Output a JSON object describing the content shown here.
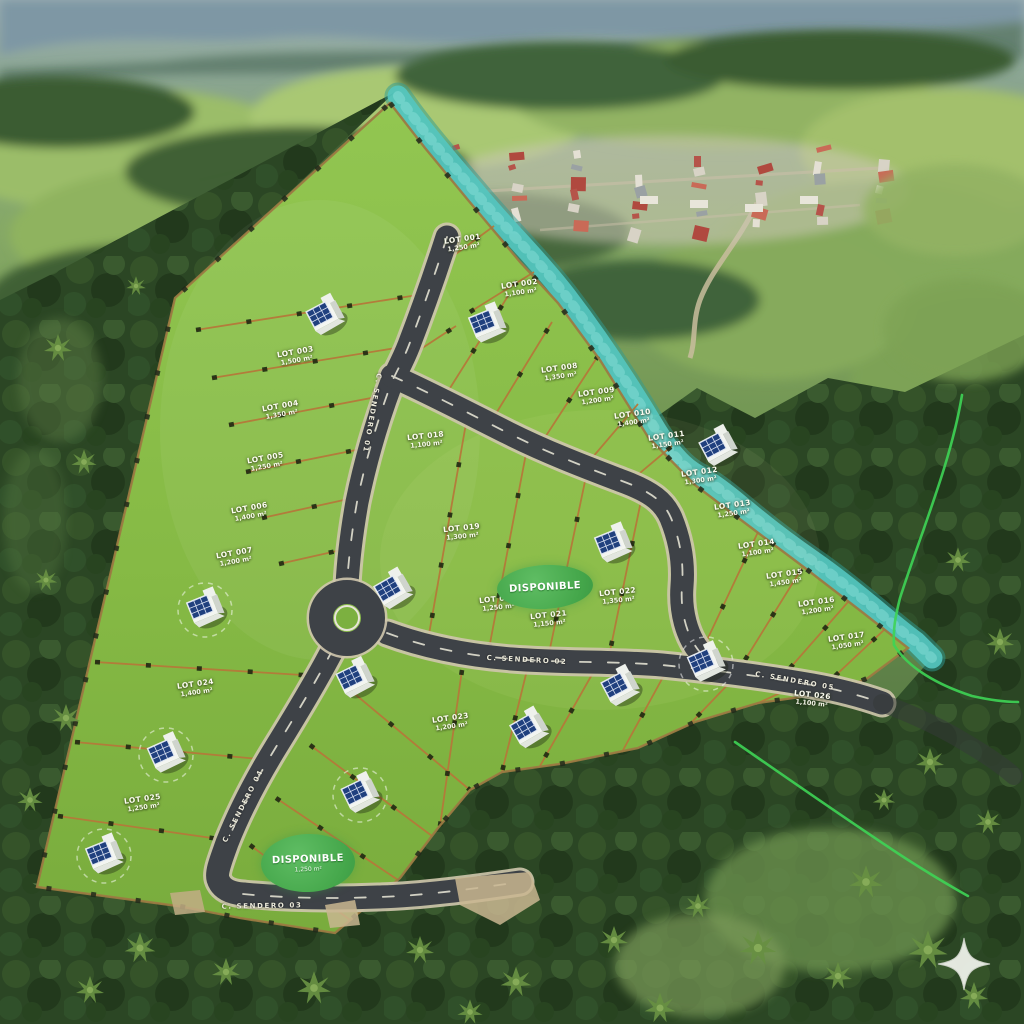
{
  "map": {
    "colors": {
      "parcel_green": "#86ba45",
      "lot_line": "#b5793a",
      "river_teal": "#54c7c0",
      "road_asphalt": "#3e4247",
      "badge_green": "#45a74b",
      "survey_line_green": "#3ed455",
      "label_text": "#fdfdf2",
      "star_logo": "#edf0e9"
    },
    "badges": [
      {
        "label": "DISPONIBLE",
        "sub": "",
        "x": 545,
        "y": 587,
        "w": 96,
        "h": 44,
        "rot": -3
      },
      {
        "label": "DISPONIBLE",
        "sub": "1,250 m²",
        "x": 308,
        "y": 863,
        "w": 94,
        "h": 58,
        "rot": -2
      }
    ],
    "road_labels": [
      {
        "text": "C. SENDERO 01",
        "x": 372,
        "y": 413,
        "rot": 100
      },
      {
        "text": "C. SENDERO 02",
        "x": 527,
        "y": 660,
        "rot": 3
      },
      {
        "text": "C. SENDERO 03",
        "x": 262,
        "y": 906,
        "rot": -1
      },
      {
        "text": "C. SENDERO 04",
        "x": 243,
        "y": 806,
        "rot": -63
      },
      {
        "text": "C. SENDERO 05",
        "x": 795,
        "y": 681,
        "rot": 10
      }
    ],
    "lots": [
      {
        "id": "LOT 001",
        "area": "1,250 m²",
        "x": 463,
        "y": 243,
        "rot": -8
      },
      {
        "id": "LOT 002",
        "area": "1,100 m²",
        "x": 520,
        "y": 288,
        "rot": -8
      },
      {
        "id": "LOT 003",
        "area": "1,500 m²",
        "x": 296,
        "y": 356,
        "rot": -10
      },
      {
        "id": "LOT 004",
        "area": "1,350 m²",
        "x": 281,
        "y": 410,
        "rot": -10
      },
      {
        "id": "LOT 005",
        "area": "1,250 m²",
        "x": 266,
        "y": 462,
        "rot": -10
      },
      {
        "id": "LOT 006",
        "area": "1,400 m²",
        "x": 250,
        "y": 512,
        "rot": -10
      },
      {
        "id": "LOT 007",
        "area": "1,200 m²",
        "x": 235,
        "y": 557,
        "rot": -10
      },
      {
        "id": "LOT 008",
        "area": "1,350 m²",
        "x": 560,
        "y": 372,
        "rot": -8
      },
      {
        "id": "LOT 009",
        "area": "1,200 m²",
        "x": 597,
        "y": 396,
        "rot": -8
      },
      {
        "id": "LOT 010",
        "area": "1,400 m²",
        "x": 633,
        "y": 418,
        "rot": -8
      },
      {
        "id": "LOT 011",
        "area": "1,150 m²",
        "x": 667,
        "y": 440,
        "rot": -8
      },
      {
        "id": "LOT 012",
        "area": "1,300 m²",
        "x": 700,
        "y": 476,
        "rot": -8
      },
      {
        "id": "LOT 013",
        "area": "1,250 m²",
        "x": 733,
        "y": 509,
        "rot": -8
      },
      {
        "id": "LOT 014",
        "area": "1,100 m²",
        "x": 757,
        "y": 548,
        "rot": -8
      },
      {
        "id": "LOT 015",
        "area": "1,450 m²",
        "x": 785,
        "y": 578,
        "rot": -8
      },
      {
        "id": "LOT 016",
        "area": "1,200 m²",
        "x": 817,
        "y": 606,
        "rot": -8
      },
      {
        "id": "LOT 017",
        "area": "1,050 m²",
        "x": 847,
        "y": 641,
        "rot": -8
      },
      {
        "id": "LOT 018",
        "area": "1,100 m²",
        "x": 426,
        "y": 440,
        "rot": -6
      },
      {
        "id": "LOT 019",
        "area": "1,300 m²",
        "x": 462,
        "y": 532,
        "rot": -6
      },
      {
        "id": "LOT 020",
        "area": "1,250 m²",
        "x": 498,
        "y": 603,
        "rot": -6
      },
      {
        "id": "LOT 021",
        "area": "1,150 m²",
        "x": 549,
        "y": 619,
        "rot": -6
      },
      {
        "id": "LOT 022",
        "area": "1,350 m²",
        "x": 618,
        "y": 596,
        "rot": -6
      },
      {
        "id": "LOT 023",
        "area": "1,200 m²",
        "x": 451,
        "y": 722,
        "rot": -8
      },
      {
        "id": "LOT 024",
        "area": "1,400 m²",
        "x": 196,
        "y": 688,
        "rot": -8
      },
      {
        "id": "LOT 025",
        "area": "1,250 m²",
        "x": 143,
        "y": 803,
        "rot": -8
      },
      {
        "id": "LOT 026",
        "area": "1,100 m²",
        "x": 812,
        "y": 699,
        "rot": 6
      }
    ],
    "houses": {
      "icon": "solar-house-icon",
      "items": [
        {
          "x": 325,
          "y": 317,
          "rot": -28,
          "circled": false
        },
        {
          "x": 487,
          "y": 325,
          "rot": -22,
          "circled": false
        },
        {
          "x": 718,
          "y": 448,
          "rot": -28,
          "circled": false
        },
        {
          "x": 613,
          "y": 545,
          "rot": -22,
          "circled": false
        },
        {
          "x": 393,
          "y": 591,
          "rot": -30,
          "circled": false
        },
        {
          "x": 205,
          "y": 610,
          "rot": -22,
          "circled": true
        },
        {
          "x": 355,
          "y": 680,
          "rot": -26,
          "circled": false
        },
        {
          "x": 706,
          "y": 664,
          "rot": -24,
          "circled": true
        },
        {
          "x": 620,
          "y": 688,
          "rot": -28,
          "circled": false
        },
        {
          "x": 529,
          "y": 730,
          "rot": -30,
          "circled": false
        },
        {
          "x": 166,
          "y": 755,
          "rot": -24,
          "circled": true
        },
        {
          "x": 360,
          "y": 795,
          "rot": -26,
          "circled": true
        },
        {
          "x": 104,
          "y": 856,
          "rot": -22,
          "circled": true
        }
      ]
    },
    "logo": {
      "icon": "four-point-star"
    }
  }
}
